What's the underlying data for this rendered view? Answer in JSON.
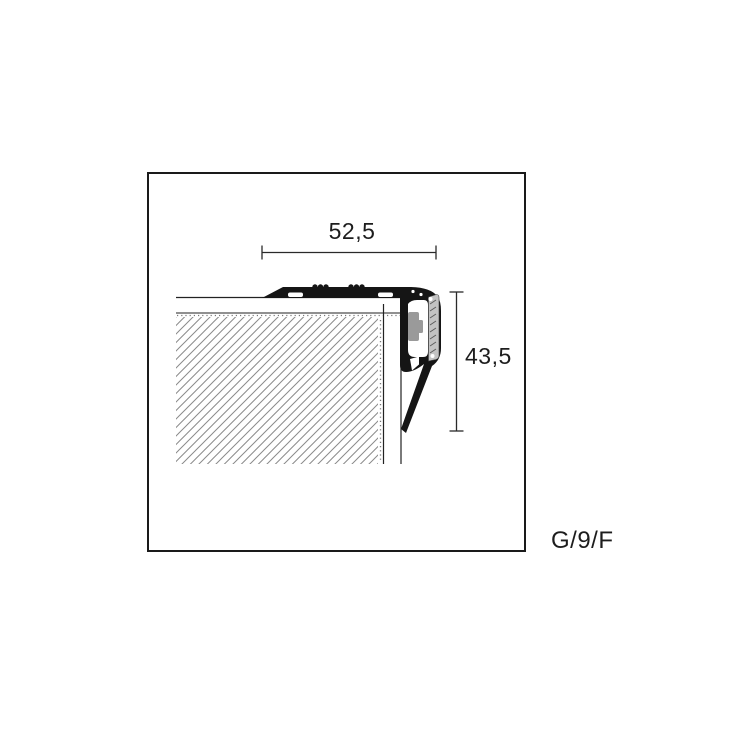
{
  "figure": {
    "kind": "profile-cross-section-technical-drawing",
    "dimensions": {
      "width_label": "52,5",
      "height_label": "43,5"
    },
    "product_code": "G/9/F",
    "colors": {
      "frame_line": "#1a1a1a",
      "profile_fill": "#151515",
      "insert_fill": "#c3c3c3",
      "block_fill": "#9a9a9a",
      "hatch_line": "#8a8a8a",
      "dimension_line": "#2a2a2a",
      "background": "#ffffff"
    }
  }
}
